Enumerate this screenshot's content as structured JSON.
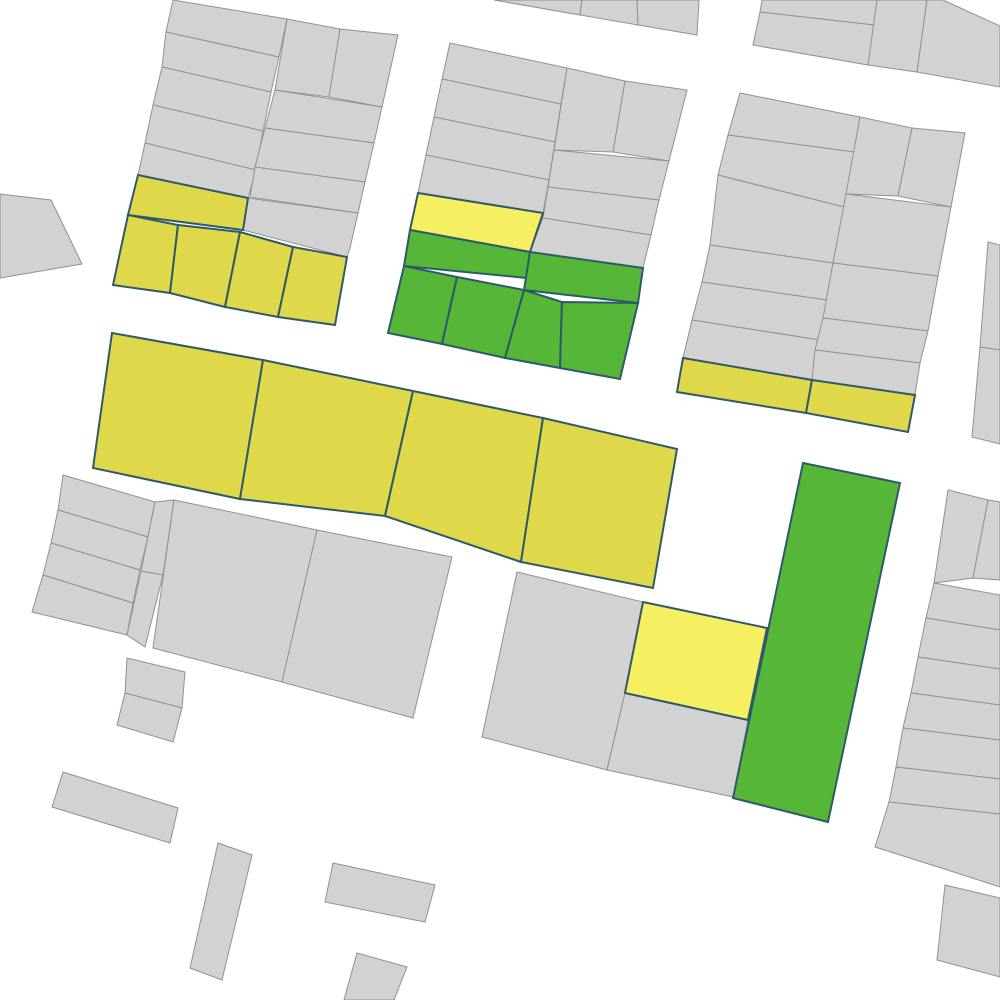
{
  "map": {
    "title": "parcel-map",
    "background": "#ffffff",
    "types": {
      "standard": {
        "fill": "#d2d2d2",
        "stroke": "#919191",
        "stroke_width": 1
      },
      "yellow": {
        "fill": "#dfd84b",
        "stroke": "#2d5a69",
        "stroke_width": 2
      },
      "bright_yellow": {
        "fill": "#f6ef62",
        "stroke": "#2d5a69",
        "stroke_width": 2
      },
      "green": {
        "fill": "#55b638",
        "stroke": "#2d5a69",
        "stroke_width": 2
      }
    },
    "parcels": [
      {
        "id": "nw-row-l1",
        "type": "standard",
        "points": "173,0 287,19 279,57 166,32"
      },
      {
        "id": "nw-row-l2",
        "type": "standard",
        "points": "166,32 279,57 271,92 162,67"
      },
      {
        "id": "nw-row-l3",
        "type": "standard",
        "points": "162,67 271,92 263,131 153,105"
      },
      {
        "id": "nw-row-l4",
        "type": "standard",
        "points": "153,105 263,131 256,170 145,143"
      },
      {
        "id": "nw-row-l5",
        "type": "standard",
        "points": "145,143 256,170 248,198 138,175"
      },
      {
        "id": "nw-tall-a",
        "type": "standard",
        "points": "287,19 340,29 329,97 275,90"
      },
      {
        "id": "nw-tall-b",
        "type": "standard",
        "points": "340,29 398,35 382,107 329,97"
      },
      {
        "id": "nw-row-r1",
        "type": "standard",
        "points": "275,90 382,107 374,143 265,128"
      },
      {
        "id": "nw-row-r2",
        "type": "standard",
        "points": "265,128 374,143 365,182 255,167"
      },
      {
        "id": "nw-row-r3",
        "type": "standard",
        "points": "255,167 365,182 358,213 250,197"
      },
      {
        "id": "nw-row-r4",
        "type": "standard",
        "points": "248,198 358,213 350,248 347,257 243,230"
      },
      {
        "id": "nw-yellow-strip",
        "type": "yellow",
        "points": "138,175 248,198 243,230 128,215"
      },
      {
        "id": "nw-yellow-1",
        "type": "yellow",
        "points": "128,215 178,225 170,293 113,285"
      },
      {
        "id": "nw-yellow-2",
        "type": "yellow",
        "points": "178,225 240,232 225,307 170,293"
      },
      {
        "id": "nw-yellow-3",
        "type": "yellow",
        "points": "240,232 293,247 278,317 225,307"
      },
      {
        "id": "nw-yellow-4",
        "type": "yellow",
        "points": "293,247 347,257 335,325 278,317"
      },
      {
        "id": "nm-row-l1",
        "type": "standard",
        "points": "450,43 567,68 561,104 442,79"
      },
      {
        "id": "nm-row-l2",
        "type": "standard",
        "points": "442,79 561,104 555,142 434,117"
      },
      {
        "id": "nm-row-l3",
        "type": "standard",
        "points": "434,117 555,142 549,180 426,155"
      },
      {
        "id": "nm-row-l4",
        "type": "standard",
        "points": "426,155 549,180 543,213 418,193"
      },
      {
        "id": "nm-tall-a",
        "type": "standard",
        "points": "567,68 625,81 613,152 554,150"
      },
      {
        "id": "nm-tall-b",
        "type": "standard",
        "points": "625,81 687,90 669,161 613,152"
      },
      {
        "id": "nm-row-r1",
        "type": "standard",
        "points": "554,150 669,161 659,200 548,187"
      },
      {
        "id": "nm-row-r2",
        "type": "standard",
        "points": "548,187 659,200 651,235 543,218"
      },
      {
        "id": "nm-row-r3",
        "type": "standard",
        "points": "543,218 651,235 643,268 530,252"
      },
      {
        "id": "nm-bright-yellow",
        "type": "bright_yellow",
        "points": "418,193 543,213 530,252 410,230"
      },
      {
        "id": "nm-green-strip",
        "type": "green",
        "points": "410,230 530,252 527,278 404,266"
      },
      {
        "id": "nm-green-right",
        "type": "green",
        "points": "530,252 643,268 638,303 524,290"
      },
      {
        "id": "nm-green-1",
        "type": "green",
        "points": "404,266 457,277 442,344 388,333"
      },
      {
        "id": "nm-green-2",
        "type": "green",
        "points": "457,277 524,290 505,358 442,344"
      },
      {
        "id": "nm-green-3",
        "type": "green",
        "points": "524,290 562,302 560,368 505,358"
      },
      {
        "id": "nm-green-4",
        "type": "green",
        "points": "562,302 638,303 620,379 560,368"
      },
      {
        "id": "ne-row-l1",
        "type": "standard",
        "points": "740,93 860,117 854,152 728,135"
      },
      {
        "id": "ne-row-l2",
        "type": "standard",
        "points": "728,135 854,152 844,207 718,175"
      },
      {
        "id": "ne-row-l3",
        "type": "standard",
        "points": "718,175 844,207 833,263 710,245"
      },
      {
        "id": "ne-row-l4",
        "type": "standard",
        "points": "710,245 833,263 827,300 702,282"
      },
      {
        "id": "ne-row-l5",
        "type": "standard",
        "points": "702,282 827,300 820,340 692,320"
      },
      {
        "id": "ne-row-l6",
        "type": "standard",
        "points": "692,320 820,340 812,380 683,358"
      },
      {
        "id": "ne-tall-a",
        "type": "standard",
        "points": "860,117 912,128 898,196 846,194"
      },
      {
        "id": "ne-tall-b",
        "type": "standard",
        "points": "912,128 965,133 951,207 898,196"
      },
      {
        "id": "ne-row-r1",
        "type": "standard",
        "points": "846,194 951,207 938,276 833,263"
      },
      {
        "id": "ne-row-r2",
        "type": "standard",
        "points": "833,263 938,276 928,331 823,318"
      },
      {
        "id": "ne-row-r3",
        "type": "standard",
        "points": "823,318 928,331 920,363 815,350"
      },
      {
        "id": "ne-row-r4",
        "type": "standard",
        "points": "815,350 920,363 915,395 812,380"
      },
      {
        "id": "ne-yellow-1",
        "type": "yellow",
        "points": "683,358 812,380 806,413 677,392"
      },
      {
        "id": "ne-yellow-2",
        "type": "yellow",
        "points": "812,380 915,395 908,432 806,413"
      },
      {
        "id": "top-frag-1",
        "type": "standard",
        "points": "494,0 582,0 580,15"
      },
      {
        "id": "top-frag-2",
        "type": "standard",
        "points": "582,0 637,0 638,25 580,15"
      },
      {
        "id": "top-frag-3",
        "type": "standard",
        "points": "637,0 699,0 697,35 638,25"
      },
      {
        "id": "corner-ne-1",
        "type": "standard",
        "points": "762,0 877,0 874,25 760,12"
      },
      {
        "id": "corner-ne-2",
        "type": "standard",
        "points": "760,12 874,25 868,65 753,45"
      },
      {
        "id": "corner-ne-3",
        "type": "standard",
        "points": "877,0 927,0 917,72 868,65"
      },
      {
        "id": "corner-ne-4",
        "type": "standard",
        "points": "927,0 943,0 1000,26 1000,87 917,72"
      },
      {
        "id": "west-edge",
        "type": "standard",
        "points": "0,194 51,200 82,264 0,278"
      },
      {
        "id": "mid-yellow-1",
        "type": "yellow",
        "points": "112,333 263,360 240,499 93,468"
      },
      {
        "id": "mid-yellow-2",
        "type": "yellow",
        "points": "263,360 413,391 385,516 240,499"
      },
      {
        "id": "mid-yellow-3",
        "type": "yellow",
        "points": "413,391 543,418 521,562 385,516"
      },
      {
        "id": "mid-yellow-4",
        "type": "yellow",
        "points": "543,418 677,449 653,588 521,562"
      },
      {
        "id": "sw-row-1",
        "type": "standard",
        "points": "63,475 155,502 148,537 58,510"
      },
      {
        "id": "sw-row-2",
        "type": "standard",
        "points": "58,510 148,537 140,570 51,543"
      },
      {
        "id": "sw-row-3",
        "type": "standard",
        "points": "51,543 140,570 133,603 43,575"
      },
      {
        "id": "sw-row-4",
        "type": "standard",
        "points": "43,575 133,603 127,635 32,612"
      },
      {
        "id": "sw-strip-1",
        "type": "standard",
        "points": "155,502 174,500 163,575 141,571"
      },
      {
        "id": "sw-strip-2",
        "type": "standard",
        "points": "141,571 163,575 145,647 127,635"
      },
      {
        "id": "sw-big-1",
        "type": "standard",
        "points": "174,500 317,530 282,682 153,648"
      },
      {
        "id": "sw-big-2",
        "type": "standard",
        "points": "317,530 452,557 413,718 282,682"
      },
      {
        "id": "sw-small-a",
        "type": "standard",
        "points": "127,658 185,672 182,708 125,693"
      },
      {
        "id": "sw-small-b",
        "type": "standard",
        "points": "125,693 182,708 173,742 117,725"
      },
      {
        "id": "sm-gray-left",
        "type": "standard",
        "points": "517,572 643,602 625,693 607,770 482,737"
      },
      {
        "id": "sm-bright-yellow",
        "type": "bright_yellow",
        "points": "643,602 767,628 748,720 625,693"
      },
      {
        "id": "sm-gray-right",
        "type": "standard",
        "points": "625,693 748,720 733,797 607,770"
      },
      {
        "id": "green-tower",
        "type": "green",
        "points": "803,463 900,483 828,822 733,798"
      },
      {
        "id": "east-sliver-1",
        "type": "standard",
        "points": "988,242 1000,245 1000,350 980,347"
      },
      {
        "id": "east-sliver-2",
        "type": "standard",
        "points": "980,347 1000,350 1000,444 972,437"
      },
      {
        "id": "se-tall",
        "type": "standard",
        "points": "948,490 988,500 973,578 934,583"
      },
      {
        "id": "se-tall-sliver",
        "type": "standard",
        "points": "988,500 1000,502 1000,580 973,578"
      },
      {
        "id": "se-row-1",
        "type": "standard",
        "points": "934,583 1000,595 1000,630 926,618"
      },
      {
        "id": "se-row-2",
        "type": "standard",
        "points": "926,618 1000,630 1000,669 918,657"
      },
      {
        "id": "se-row-3",
        "type": "standard",
        "points": "918,657 1000,669 1000,705 911,693"
      },
      {
        "id": "se-row-4",
        "type": "standard",
        "points": "911,693 1000,705 1000,740 903,728"
      },
      {
        "id": "se-row-5",
        "type": "standard",
        "points": "903,728 1000,740 1000,779 896,767"
      },
      {
        "id": "se-row-6",
        "type": "standard",
        "points": "896,767 1000,779 1000,814 889,802"
      },
      {
        "id": "se-row-7",
        "type": "standard",
        "points": "889,802 1000,814 1000,887 957,873 875,847"
      },
      {
        "id": "se-corner",
        "type": "standard",
        "points": "945,885 1000,898 1000,977 937,960"
      },
      {
        "id": "bldg-1",
        "type": "standard",
        "points": "63,772 178,808 170,843 52,807"
      },
      {
        "id": "bldg-2",
        "type": "standard",
        "points": "218,843 252,855 222,980 190,968"
      },
      {
        "id": "bldg-3",
        "type": "standard",
        "points": "333,863 435,885 425,922 325,902"
      },
      {
        "id": "bldg-4",
        "type": "standard",
        "points": "357,953 407,967 394,1000 344,1000"
      }
    ]
  }
}
